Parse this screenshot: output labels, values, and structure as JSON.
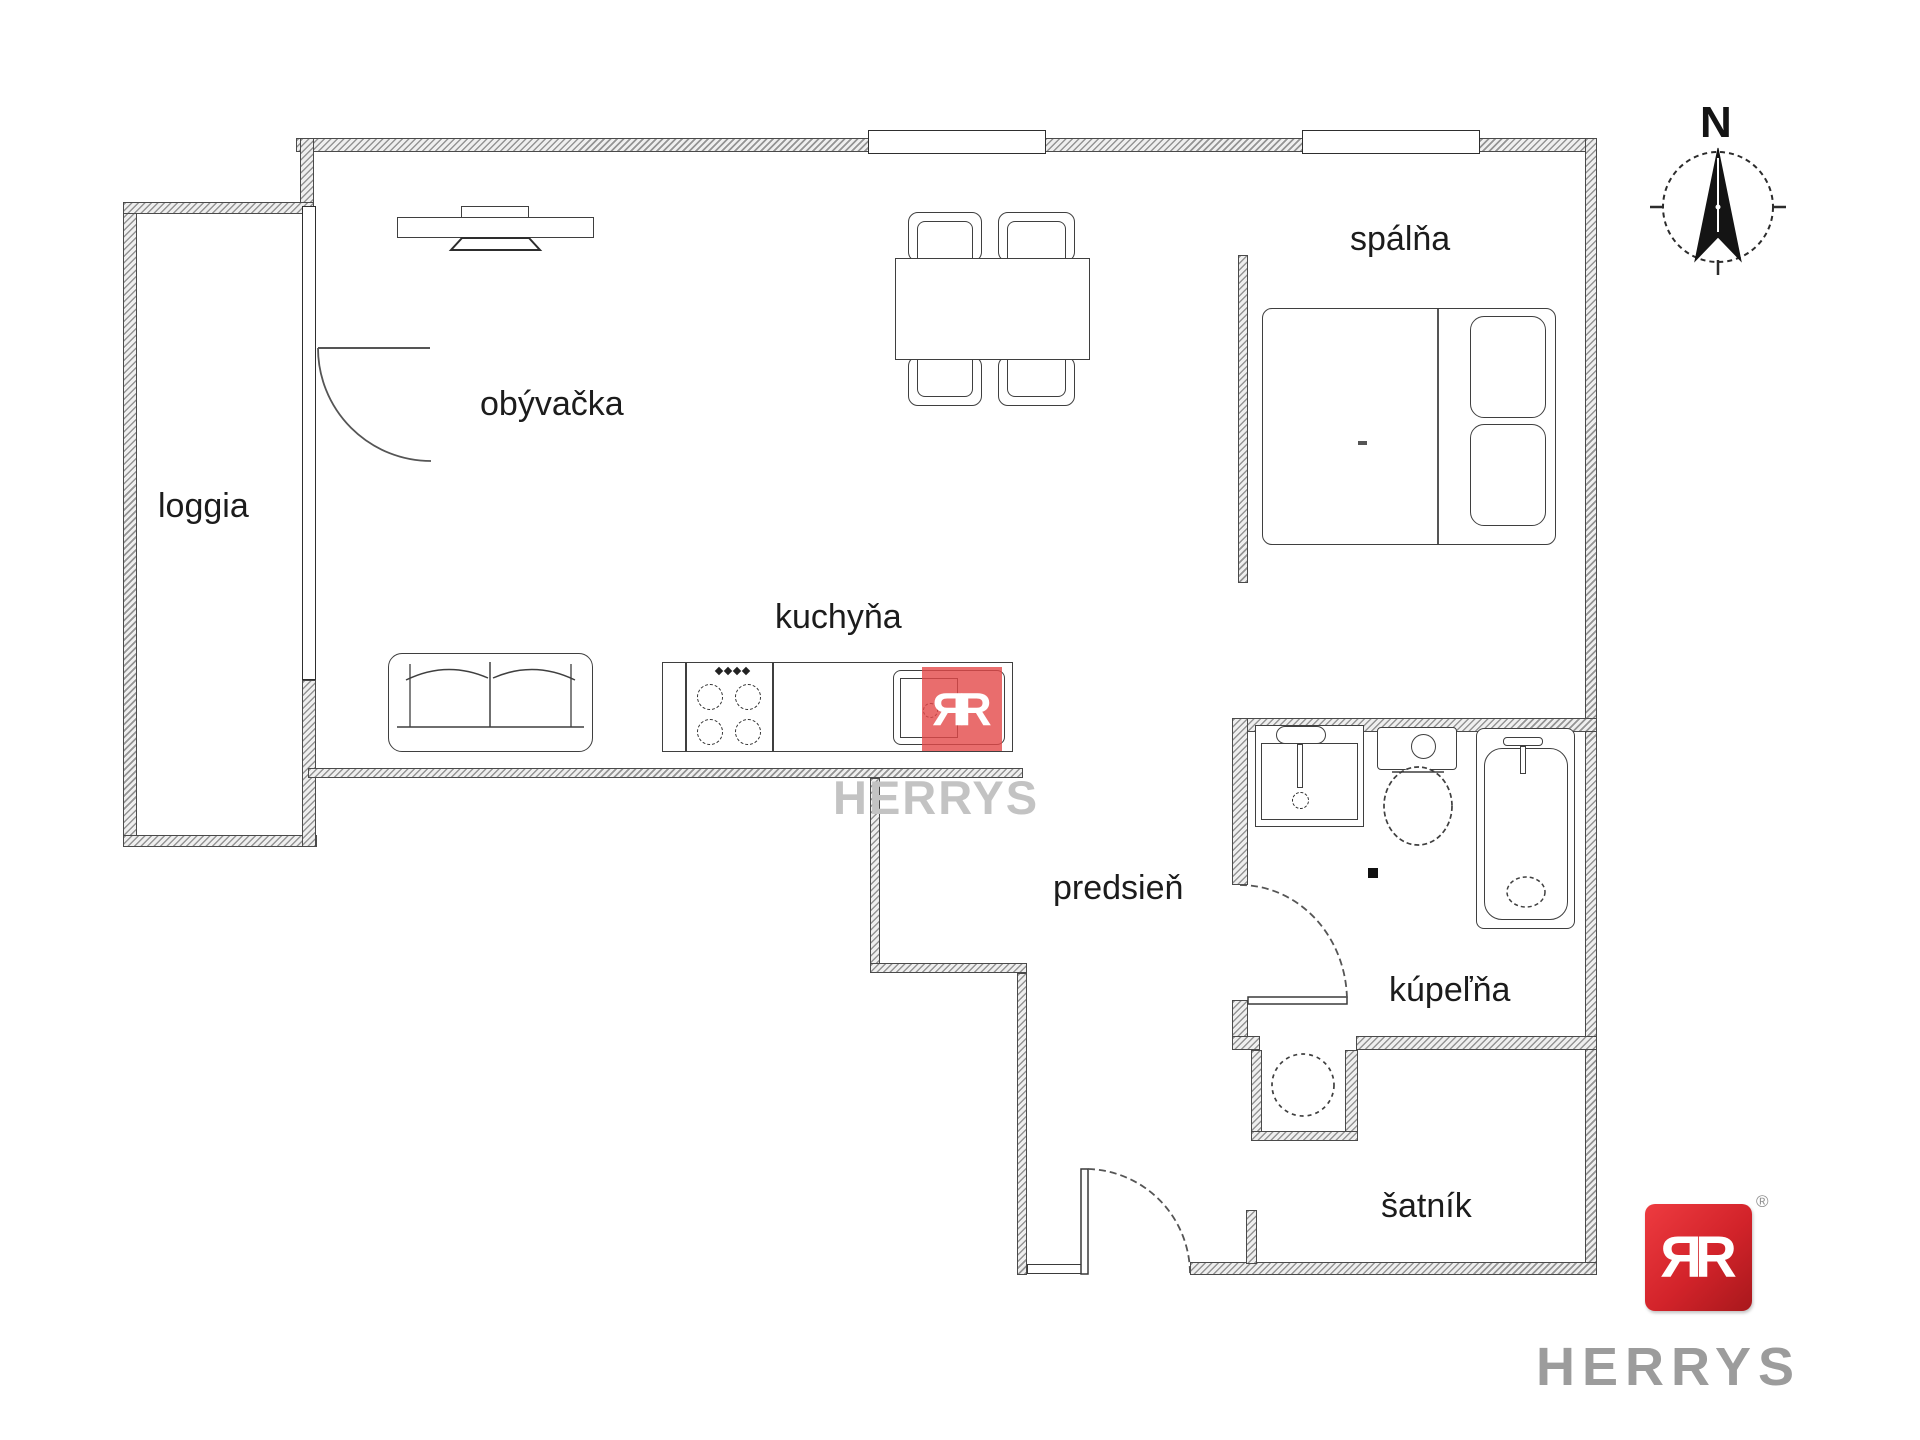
{
  "rooms": {
    "loggia": {
      "label": "loggia"
    },
    "living": {
      "label": "obývačka"
    },
    "kitchen": {
      "label": "kuchyňa"
    },
    "bedroom": {
      "label": "spálňa"
    },
    "hallway": {
      "label": "predsieň"
    },
    "bathroom": {
      "label": "kúpeľňa"
    },
    "closet": {
      "label": "šatník"
    }
  },
  "compass": {
    "north_letter": "N"
  },
  "branding": {
    "watermark_text": "HERRYS",
    "logo_text": "HERRYS",
    "monogram_letter": "R",
    "registered_mark": "®",
    "logo_red": "#d2232a",
    "watermark_red": "rgba(227,73,73,0.8)",
    "watermark_gray": "#c3c3c3",
    "logo_text_gray": "#9c9c9c"
  }
}
